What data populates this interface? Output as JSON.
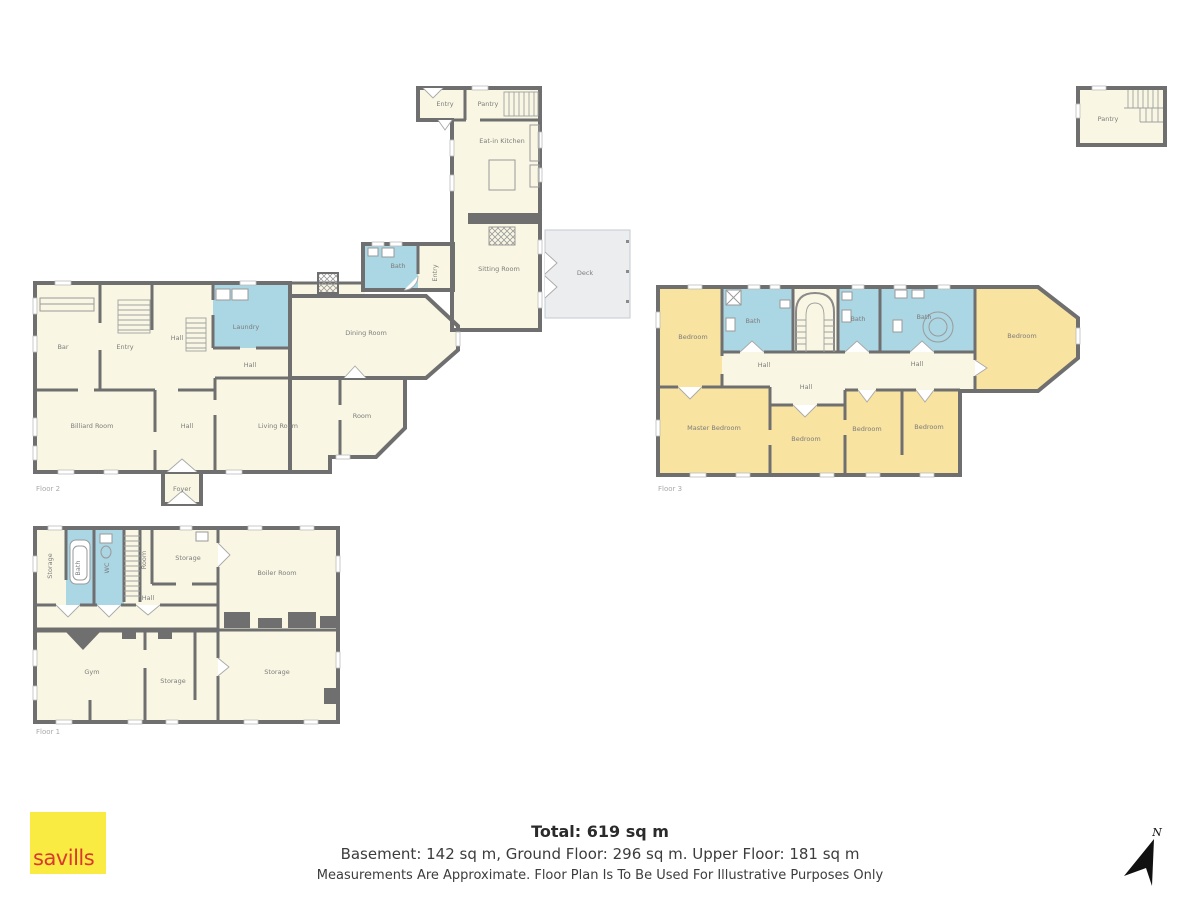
{
  "title_block": {
    "total": "Total: 619 sq m",
    "floor_areas": "Basement: 142 sq m,  Ground Floor: 296 sq m. Upper Floor: 181 sq m",
    "disclaimer": "Measurements Are Approximate. Floor Plan Is To Be Used For Illustrative Purposes Only"
  },
  "branding": {
    "logo": "savills"
  },
  "compass": {
    "north": "N"
  },
  "ground_floor": {
    "floor_label": "Floor 2",
    "rooms": {
      "entry_top": "Entry",
      "pantry": "Pantry",
      "eat_in_kitchen": "Eat-in Kitchen",
      "sitting_room": "Sitting Room",
      "deck": "Deck",
      "bath": "Bath",
      "entry_side": "Entry",
      "bar": "Bar",
      "entry": "Entry",
      "hall_upper": "Hall",
      "laundry": "Laundry",
      "hall_mid": "Hall",
      "dining_room": "Dining Room",
      "billiard_room": "Billiard Room",
      "hall_lower": "Hall",
      "living_room": "Living Room",
      "room": "Room",
      "foyer": "Foyer"
    }
  },
  "upper_floor": {
    "floor_label": "Floor 3",
    "rooms": {
      "bedroom_left": "Bedroom",
      "bath_left": "Bath",
      "bath_middle": "Bath",
      "bath_large": "Bath",
      "bedroom_right": "Bedroom",
      "hall_left": "Hall",
      "hall_center": "Hall",
      "hall_right": "Hall",
      "master_bedroom": "Master Bedroom",
      "bedroom_center": "Bedroom",
      "bedroom_third": "Bedroom",
      "bedroom_fourth": "Bedroom"
    }
  },
  "basement": {
    "floor_label": "Floor 1",
    "rooms": {
      "storage_left": "Storage",
      "bath": "Bath",
      "wc": "WC",
      "room": "Room",
      "storage_top": "Storage",
      "boiler_room": "Boiler Room",
      "hall": "Hall",
      "gym": "Gym",
      "storage_mid": "Storage",
      "storage_right": "Storage"
    }
  },
  "outbuilding": {
    "rooms": {
      "pantry": "Pantry"
    }
  },
  "colors": {
    "room_fill": "#F9F7E3",
    "bedroom_fill": "#F8E3A0",
    "bath_fill": "#ABD6E4",
    "wall": "#6F6F6F",
    "deck_fill": "#ECEDEF",
    "logo_bg": "#F9EB41",
    "logo_text": "#DB3832"
  }
}
